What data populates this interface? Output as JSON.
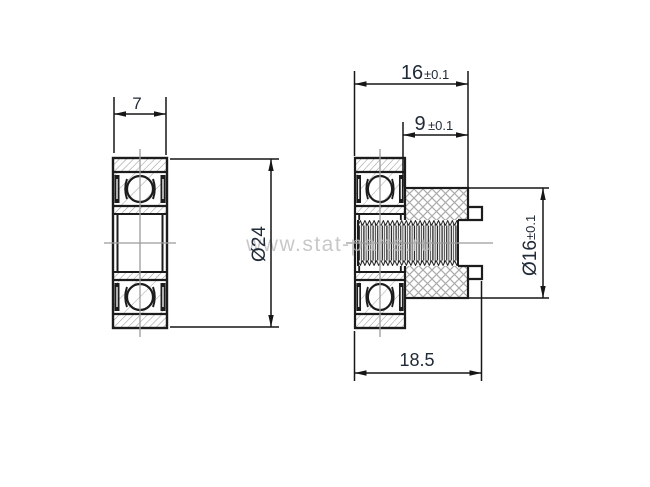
{
  "drawing": {
    "type": "engineering-drawing",
    "subject": "pulley with sealed ball bearing and threaded hub",
    "watermark": {
      "text": "www.stat-parts.ru"
    },
    "dimensions": {
      "bearing_width": {
        "value": "7"
      },
      "bearing_od": {
        "value": "Ø24"
      },
      "assembly_width": {
        "value": "16",
        "tolerance": "±0.1"
      },
      "hub_width": {
        "value": "9",
        "tolerance": "±0.1"
      },
      "hub_od": {
        "value": "Ø16",
        "tolerance": "±0.1"
      },
      "overall_length": {
        "value": "18.5"
      }
    },
    "colors": {
      "outline": "#1c1c1c",
      "dimension_text": "#212b38",
      "centerline": "#9b9b9b",
      "hatch": "#999999",
      "crosshatch": "#ababab",
      "watermark": "#bdbdbd",
      "background": "#ffffff"
    }
  }
}
